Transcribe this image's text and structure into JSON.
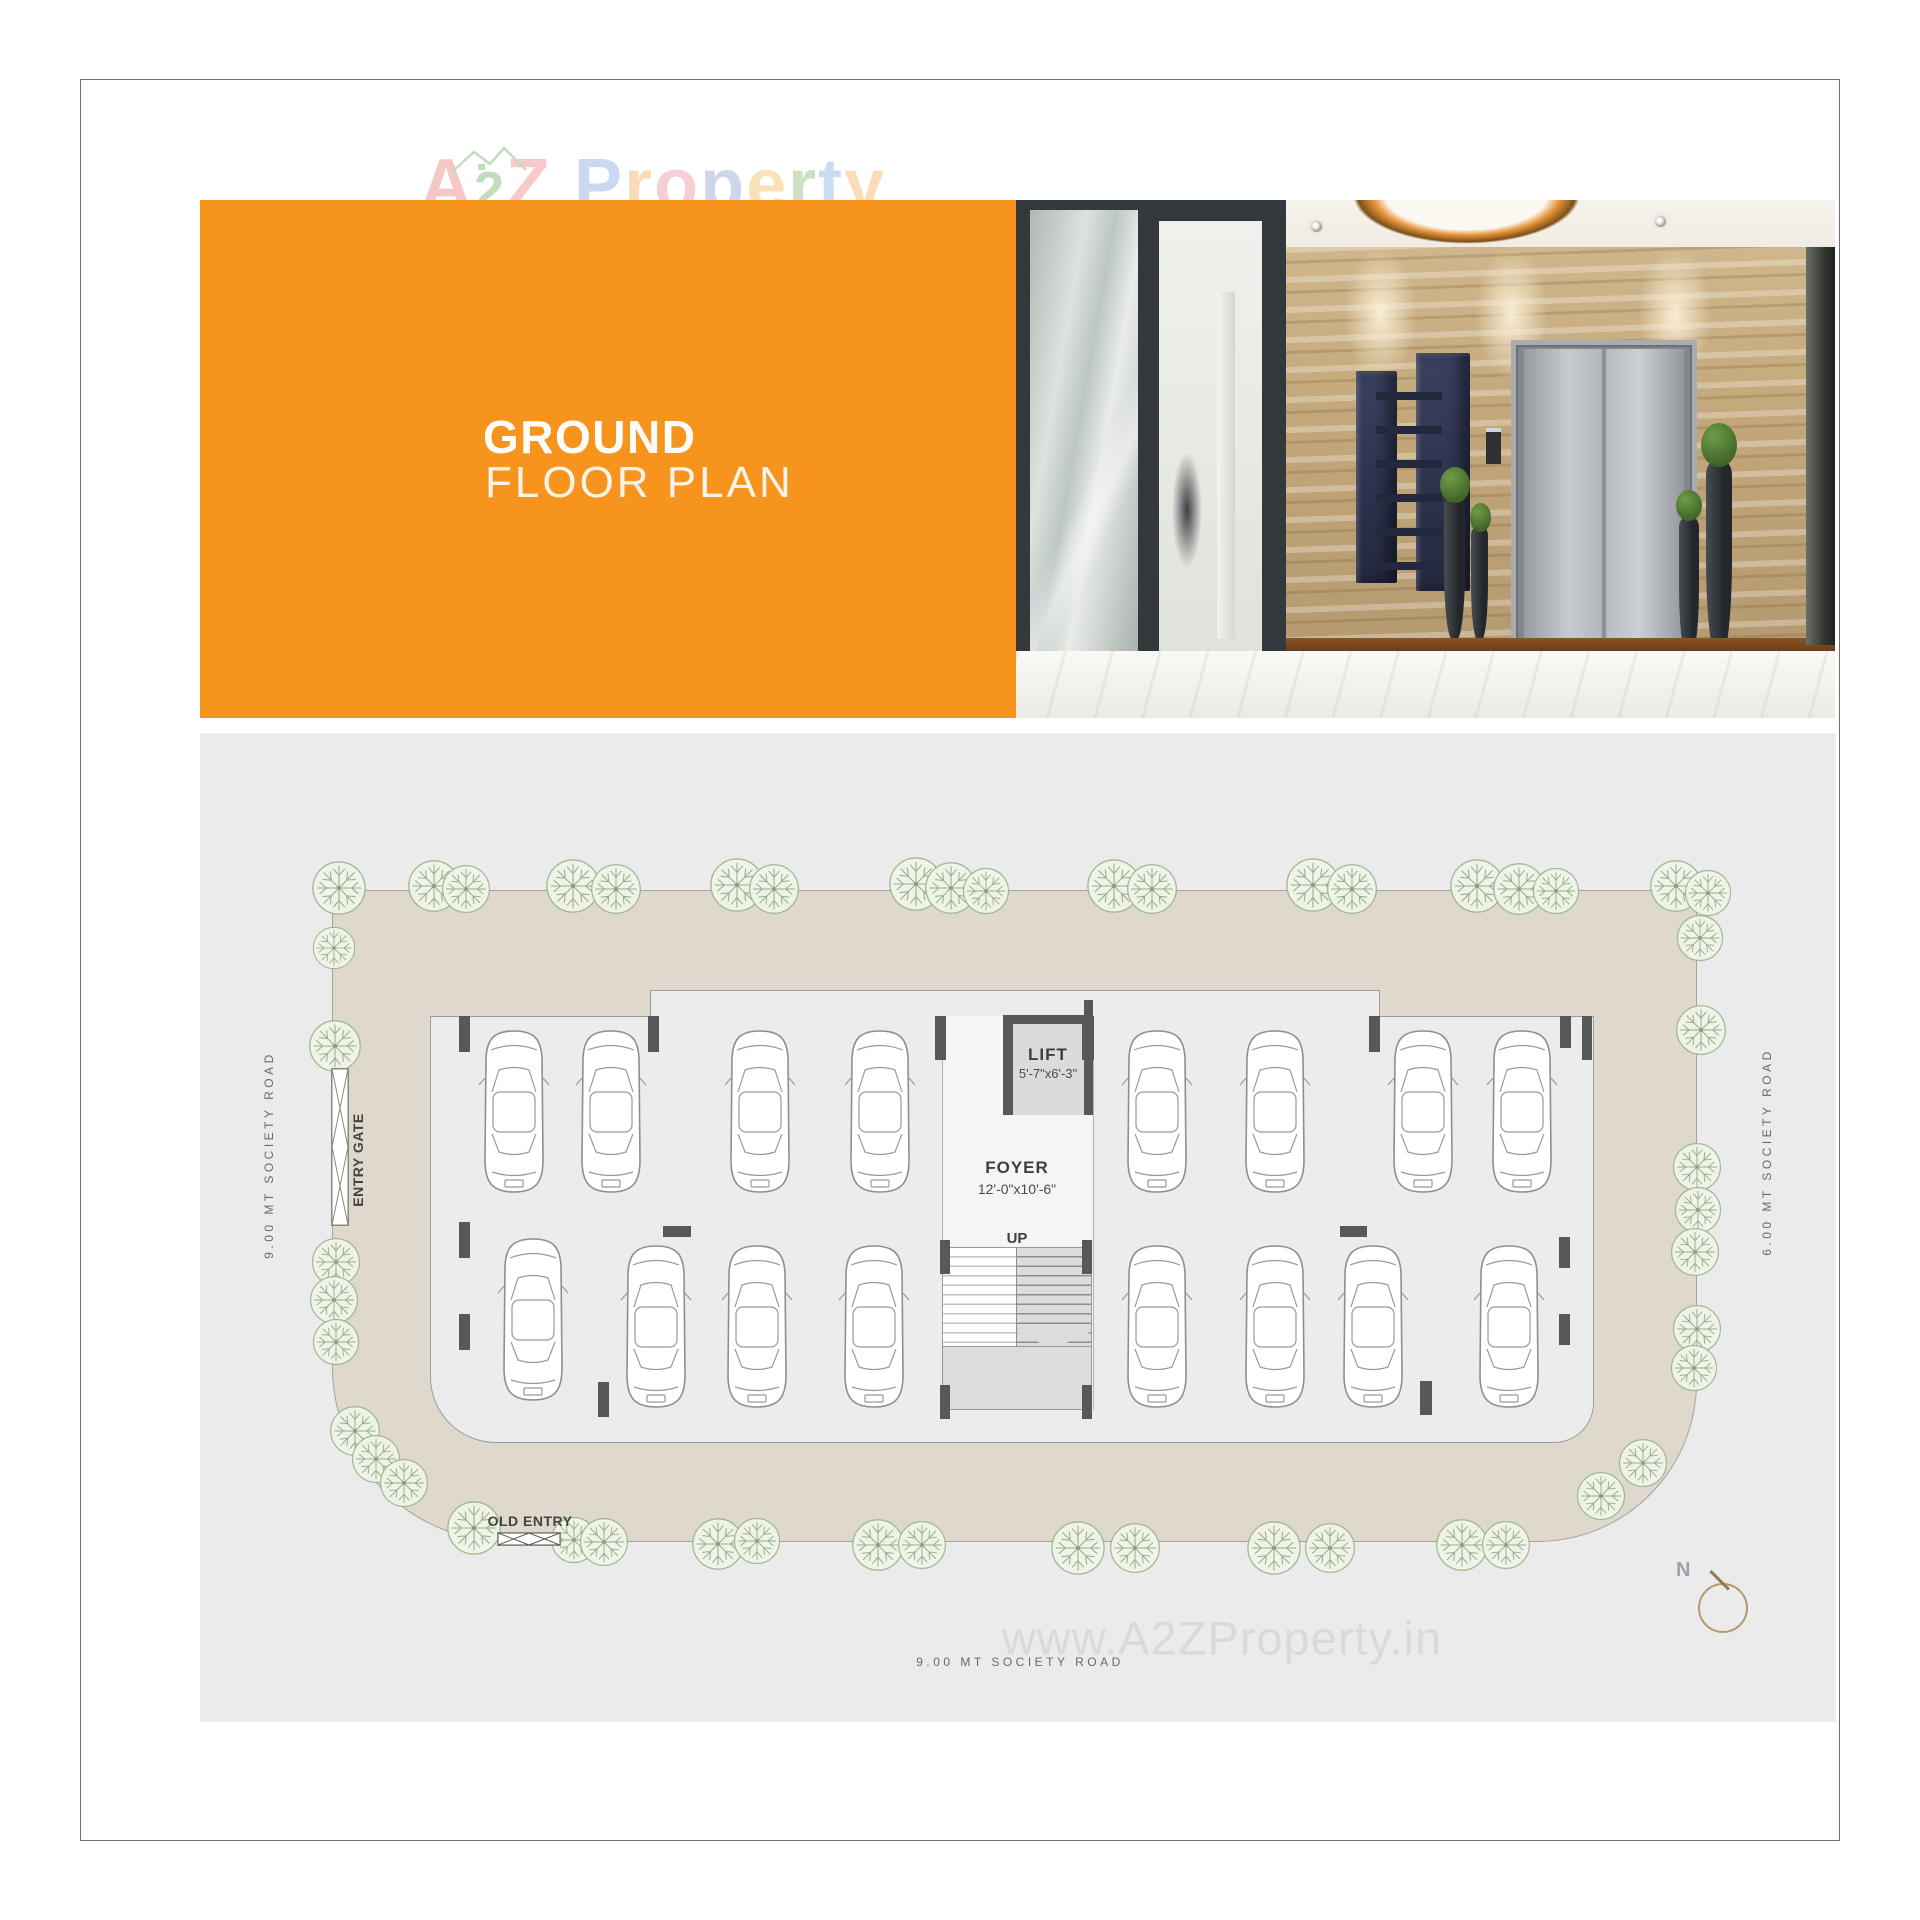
{
  "colors": {
    "accent": "#f7941e",
    "plot_beige": "#ded9cc",
    "hall_gray": "#ececec",
    "wall_dark": "#57585a",
    "tree_green": "#8fae82",
    "car_line": "#8f8f8f",
    "road_ink": "#6a6a64",
    "watermark_gray": "#d9dadc"
  },
  "logo": {
    "letters": [
      {
        "c": "A",
        "color": "#f0a6a6"
      },
      {
        "c": "2",
        "color": "#9fc795",
        "small": true
      },
      {
        "c": "Z",
        "color": "#f2a9ac"
      },
      {
        "c": " "
      },
      {
        "c": "P",
        "color": "#aac3ea"
      },
      {
        "c": "r",
        "color": "#f6c491"
      },
      {
        "c": "o",
        "color": "#f2b3bb"
      },
      {
        "c": "p",
        "color": "#b3bedd"
      },
      {
        "c": "e",
        "color": "#f6cf8f"
      },
      {
        "c": "r",
        "color": "#abcf9f"
      },
      {
        "c": "t",
        "color": "#a9c8ec"
      },
      {
        "c": "y",
        "color": "#f7c98e"
      }
    ]
  },
  "header": {
    "title_line1": "GROUND",
    "title_line2": "FLOOR PLAN"
  },
  "plan": {
    "labels": {
      "lift": "LIFT",
      "lift_dim": "5'-7\"x6'-3\"",
      "foyer": "FOYER",
      "foyer_dim": "12'-0\"x10'-6\"",
      "up": "UP",
      "entry_gate": "ENTRY GATE",
      "old_entry": "OLD ENTRY",
      "road_left": "9.00 MT SOCIETY ROAD",
      "road_right": "6.00 MT SOCIETY ROAD",
      "road_bottom": "9.00 MT SOCIETY ROAD",
      "north": "N"
    },
    "watermark": "www.A2ZProperty.in",
    "cars": [
      [
        314,
        295
      ],
      [
        411,
        295
      ],
      [
        560,
        295
      ],
      [
        680,
        295
      ],
      [
        957,
        295
      ],
      [
        1075,
        295
      ],
      [
        1223,
        295
      ],
      [
        1322,
        295
      ],
      [
        333,
        503
      ],
      [
        456,
        510
      ],
      [
        557,
        510
      ],
      [
        674,
        510
      ],
      [
        957,
        510
      ],
      [
        1075,
        510
      ],
      [
        1173,
        510
      ],
      [
        1309,
        510
      ]
    ],
    "walls": [
      [
        259,
        283,
        11,
        36
      ],
      [
        448,
        283,
        11,
        36
      ],
      [
        735,
        283,
        11,
        44
      ],
      [
        882,
        283,
        12,
        44
      ],
      [
        1169,
        283,
        11,
        36
      ],
      [
        1360,
        283,
        11,
        32
      ],
      [
        1382,
        283,
        10,
        44
      ],
      [
        259,
        489,
        11,
        36
      ],
      [
        259,
        581,
        11,
        36
      ],
      [
        463,
        493,
        28,
        11
      ],
      [
        1140,
        493,
        27,
        11
      ],
      [
        398,
        649,
        11,
        35
      ],
      [
        1220,
        648,
        12,
        34
      ],
      [
        1359,
        504,
        11,
        31
      ],
      [
        1359,
        581,
        11,
        31
      ],
      [
        740,
        507,
        10,
        34
      ],
      [
        882,
        507,
        10,
        34
      ],
      [
        740,
        652,
        10,
        34
      ],
      [
        882,
        652,
        10,
        34
      ]
    ],
    "trees": [
      [
        139,
        155,
        58
      ],
      [
        234,
        153,
        56
      ],
      [
        266,
        156,
        52
      ],
      [
        373,
        153,
        58
      ],
      [
        416,
        156,
        54
      ],
      [
        537,
        152,
        58
      ],
      [
        574,
        156,
        54
      ],
      [
        716,
        151,
        58
      ],
      [
        751,
        155,
        56
      ],
      [
        786,
        158,
        50
      ],
      [
        914,
        153,
        58
      ],
      [
        952,
        156,
        54
      ],
      [
        1113,
        152,
        58
      ],
      [
        1152,
        156,
        54
      ],
      [
        1277,
        153,
        58
      ],
      [
        1319,
        156,
        56
      ],
      [
        1356,
        158,
        50
      ],
      [
        1476,
        153,
        56
      ],
      [
        1508,
        160,
        50
      ],
      [
        134,
        215,
        46
      ],
      [
        135,
        313,
        56
      ],
      [
        136,
        529,
        52
      ],
      [
        134,
        567,
        52
      ],
      [
        136,
        609,
        50
      ],
      [
        155,
        698,
        54
      ],
      [
        176,
        726,
        52
      ],
      [
        204,
        750,
        52
      ],
      [
        274,
        795,
        58
      ],
      [
        374,
        807,
        50
      ],
      [
        404,
        809,
        52
      ],
      [
        518,
        811,
        56
      ],
      [
        557,
        808,
        50
      ],
      [
        678,
        812,
        56
      ],
      [
        722,
        812,
        52
      ],
      [
        878,
        815,
        58
      ],
      [
        935,
        815,
        54
      ],
      [
        1074,
        815,
        58
      ],
      [
        1130,
        815,
        54
      ],
      [
        1262,
        812,
        56
      ],
      [
        1306,
        812,
        52
      ],
      [
        1401,
        763,
        52
      ],
      [
        1443,
        730,
        52
      ],
      [
        1500,
        205,
        50
      ],
      [
        1501,
        297,
        54
      ],
      [
        1497,
        434,
        52
      ],
      [
        1498,
        477,
        50
      ],
      [
        1495,
        519,
        52
      ],
      [
        1497,
        596,
        52
      ],
      [
        1494,
        635,
        50
      ]
    ]
  }
}
